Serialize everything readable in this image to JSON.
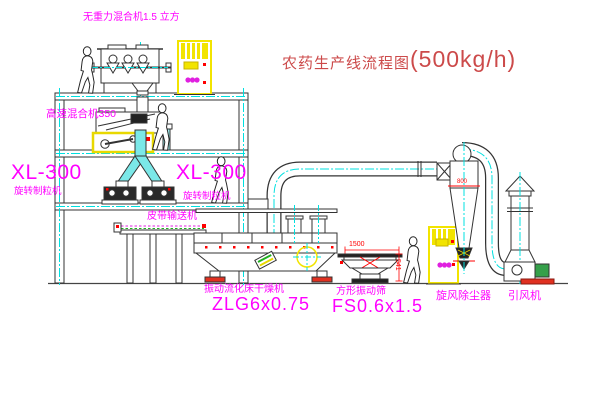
{
  "title": {
    "name_cn": "农药生产线流程图",
    "capacity": "(500kg/h)"
  },
  "equipment_labels": {
    "top_mixer": "无重力混合机1.5 立方",
    "high_speed_mixer": "高速混合机350",
    "granulator_left_model": "XL-300",
    "granulator_left_name": "旋转制粒机",
    "granulator_right_model": "XL-300",
    "granulator_right_name": "旋转制粒机",
    "belt_conveyor": "皮带输送机",
    "dryer_name": "振动流化床干燥机",
    "dryer_model": "ZLG6x0.75",
    "screen_name": "方形振动筛",
    "screen_model": "FS0.6x1.5",
    "cyclone": "旋风除尘器",
    "fan": "引风机"
  },
  "dimensions": {
    "screen_length": "1500",
    "screen_height": "541",
    "cyclone_marker": "800"
  },
  "colors": {
    "label": "#ff00ff",
    "title": "#cc4a4a",
    "dimension": "#ff0000",
    "centerline": "#00e0e0",
    "cabinet": "#f2e400",
    "motor": "#35a04a",
    "line": "#333333"
  }
}
